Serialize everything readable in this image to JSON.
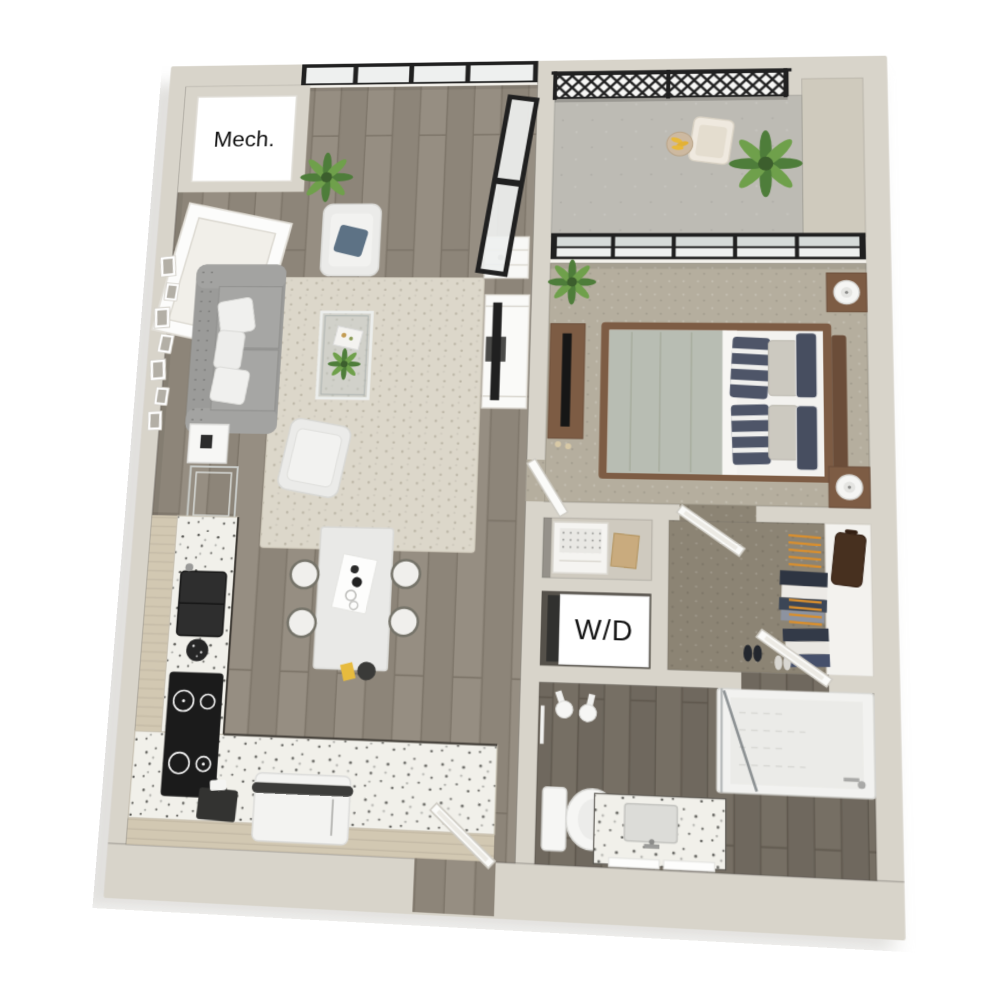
{
  "labels": {
    "mech_room": "Mech.",
    "washer_dryer": "W/D"
  },
  "colors": {
    "background": "#ffffff",
    "wall": "#d8d4ca",
    "wall_inner": "#cfcabd",
    "floor_wood": "#8d8579",
    "floor_wood_light": "#968e82",
    "floor_wood_gap": "#7a7266",
    "floor_wood_dark": "#6f685e",
    "floor_wood_dark_gap": "#5d564c",
    "carpet_bedroom": "#b5ae9e",
    "carpet_closet": "#8c8474",
    "balcony_floor": "#bdbbb4",
    "rug": "#dcd7ca",
    "rug_dot": "#b9b3a3",
    "window_frame": "#202020",
    "glass_light": "#eef0ef",
    "glass_dark": "#d6dbd9",
    "sofa_gray": "#9b9b99",
    "armchair_white": "#ebebe9",
    "pillow_blue": "#5d7285",
    "pillow_navy": "#4e5568",
    "pillow_navy_dark": "#474e60",
    "bed_duvet": "#b8bdb3",
    "wood_furniture": "#7d5c44",
    "wood_furniture_dark": "#6b4d39",
    "counter_terrazzo": "#f1f0ea",
    "cabinet_tan": "#d2c8b2",
    "island_white": "#e9e9e7",
    "appliance_dark": "#242424",
    "hanger_orange": "#d98f2e",
    "plant_green": "#4e7d3a",
    "plant_green_light": "#6fa04b",
    "suitcase_brown": "#47301f",
    "label_text": "#111111",
    "label_bg": "#ffffff"
  }
}
